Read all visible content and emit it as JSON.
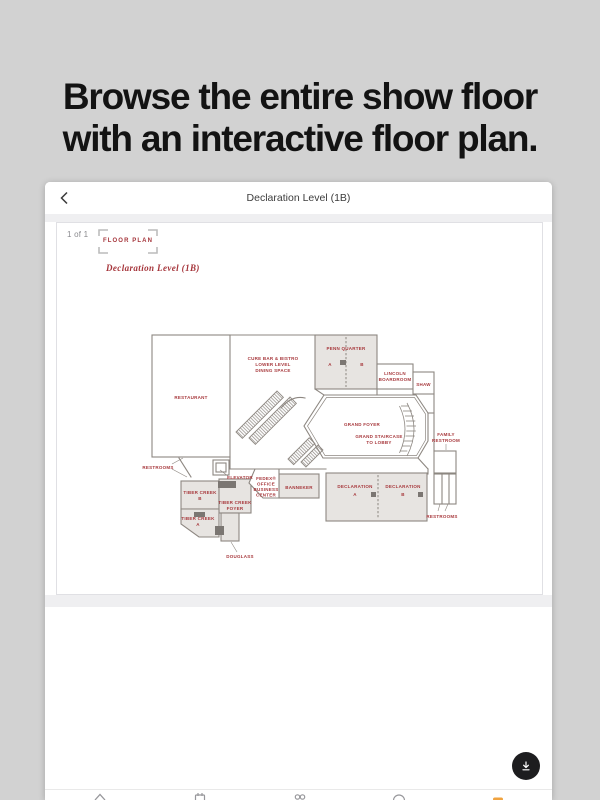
{
  "headline": {
    "line1": "Browse the entire show floor",
    "line2": "with an interactive floor plan."
  },
  "app": {
    "header": {
      "title": "Declaration Level (1B)"
    },
    "viewer": {
      "page_indicator": "1 of 1",
      "logo_text": "FLOOR PLAN",
      "plan_title": "Declaration Level (1B)"
    },
    "fab": {
      "icon": "download"
    },
    "tabbar": {
      "icons": [
        "home",
        "calendar",
        "people",
        "clock",
        "map"
      ],
      "active_index": 4,
      "active_color": "#f0a33f",
      "inactive_color": "#97979b"
    }
  },
  "plan": {
    "colors": {
      "label": "#a7383c",
      "wall": "#8d8781",
      "room_fill": "#e7e4e1",
      "block": "#7b7672"
    },
    "labels": {
      "restaurant": "RESTAURANT",
      "cure": [
        "CURE BAR & BISTRO",
        "LOWER LEVEL",
        "DINING SPACE"
      ],
      "penn": {
        "title": "PENN QUARTER",
        "a": "A",
        "b": "B"
      },
      "lincoln": [
        "LINCOLN",
        "BOARDROOM"
      ],
      "shaw": "SHAW",
      "foyer": "GRAND FOYER",
      "staircase": [
        "GRAND STAIRCASE",
        "TO LOBBY"
      ],
      "family": [
        "FAMILY",
        "RESTROOM"
      ],
      "restrooms_left": "RESTROOMS",
      "elevator": "ELEVATOR",
      "fedex": [
        "FEDEX®",
        "OFFICE",
        "BUSINESS",
        "CENTER"
      ],
      "banneker": "BANNEKER",
      "declaration": {
        "title": "DECLARATION",
        "a": "A",
        "b": "B"
      },
      "restrooms_right": "RESTROOMS",
      "tiber": {
        "title": "TIBER CREEK",
        "a": "A",
        "b": "B",
        "foyer": "FOYER"
      },
      "douglass": "DOUGLASS"
    }
  }
}
